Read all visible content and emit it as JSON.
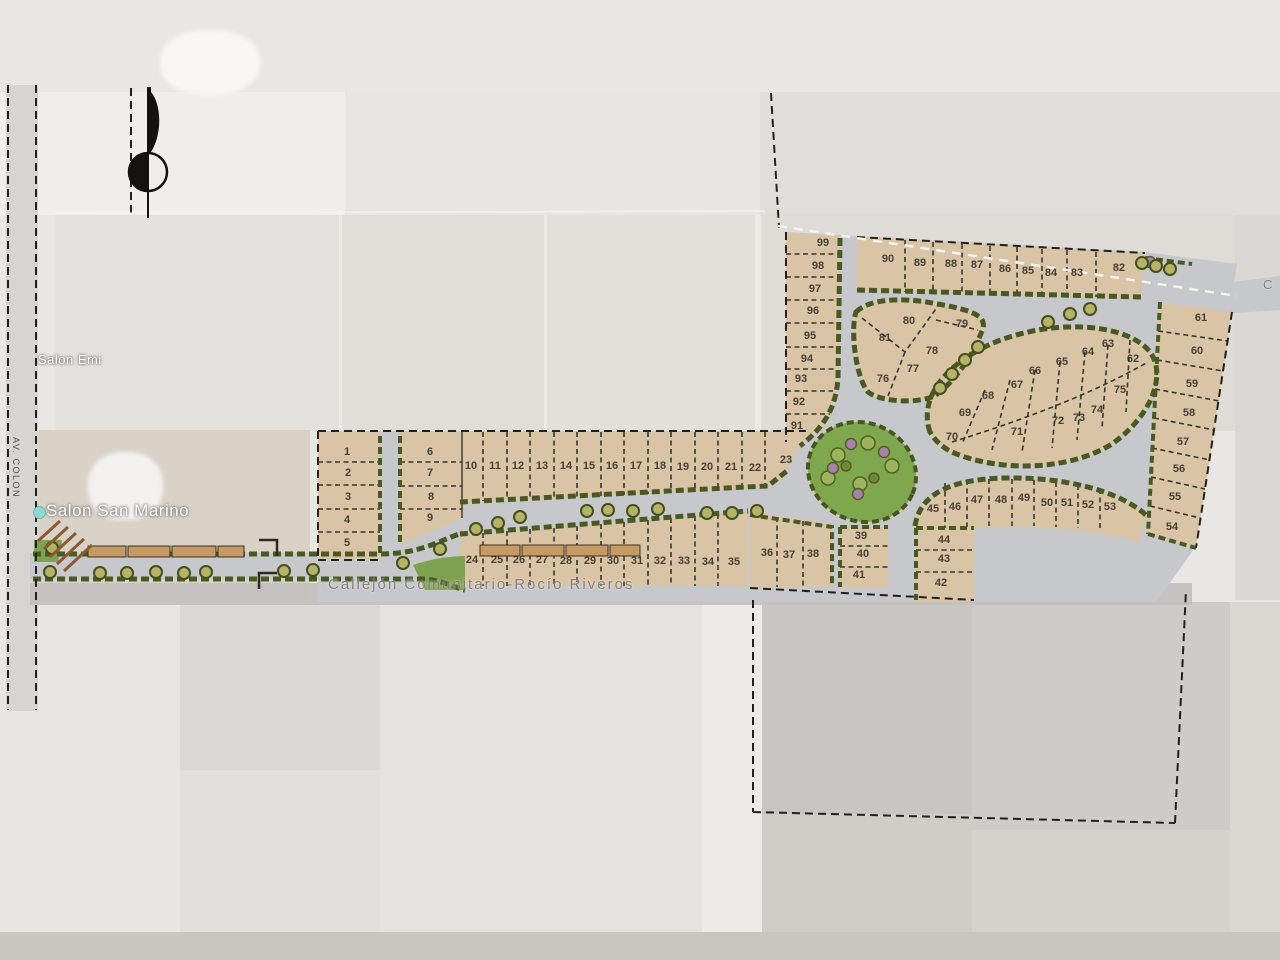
{
  "map": {
    "compass": {
      "icon": "north-arrow"
    },
    "labels": {
      "av_colon": "AV. COLON",
      "salon_emi": "Salon Emi",
      "salon_san_marino": "Salon San Marino",
      "callejon": "Callejón Comunitario-Rocío Riveros",
      "right_edge_street": "C"
    },
    "lots": [
      [
        "1",
        347,
        452
      ],
      [
        "2",
        348,
        473
      ],
      [
        "3",
        348,
        497
      ],
      [
        "4",
        347,
        520
      ],
      [
        "5",
        347,
        543
      ],
      [
        "6",
        430,
        452
      ],
      [
        "7",
        430,
        473
      ],
      [
        "8",
        431,
        497
      ],
      [
        "9",
        430,
        518
      ],
      [
        "10",
        471,
        466
      ],
      [
        "11",
        495,
        466
      ],
      [
        "12",
        518,
        466
      ],
      [
        "13",
        542,
        466
      ],
      [
        "14",
        566,
        466
      ],
      [
        "15",
        589,
        466
      ],
      [
        "16",
        612,
        466
      ],
      [
        "17",
        636,
        466
      ],
      [
        "18",
        660,
        466
      ],
      [
        "19",
        683,
        467
      ],
      [
        "20",
        707,
        467
      ],
      [
        "21",
        731,
        467
      ],
      [
        "22",
        755,
        468
      ],
      [
        "23",
        786,
        460
      ],
      [
        "24",
        472,
        560
      ],
      [
        "25",
        497,
        560
      ],
      [
        "26",
        519,
        560
      ],
      [
        "27",
        542,
        560
      ],
      [
        "28",
        566,
        561
      ],
      [
        "29",
        590,
        561
      ],
      [
        "30",
        613,
        561
      ],
      [
        "31",
        637,
        561
      ],
      [
        "32",
        660,
        561
      ],
      [
        "33",
        684,
        561
      ],
      [
        "34",
        708,
        562
      ],
      [
        "35",
        734,
        562
      ],
      [
        "36",
        767,
        553
      ],
      [
        "37",
        789,
        555
      ],
      [
        "38",
        813,
        554
      ],
      [
        "39",
        861,
        536
      ],
      [
        "40",
        863,
        554
      ],
      [
        "41",
        859,
        575
      ],
      [
        "42",
        941,
        583
      ],
      [
        "43",
        944,
        559
      ],
      [
        "44",
        944,
        540
      ],
      [
        "45",
        933,
        509
      ],
      [
        "46",
        955,
        507
      ],
      [
        "47",
        977,
        500
      ],
      [
        "48",
        1001,
        500
      ],
      [
        "49",
        1024,
        498
      ],
      [
        "50",
        1047,
        503
      ],
      [
        "51",
        1067,
        503
      ],
      [
        "52",
        1088,
        505
      ],
      [
        "53",
        1110,
        507
      ],
      [
        "54",
        1172,
        527
      ],
      [
        "55",
        1175,
        497
      ],
      [
        "56",
        1179,
        469
      ],
      [
        "57",
        1183,
        442
      ],
      [
        "58",
        1189,
        413
      ],
      [
        "59",
        1192,
        384
      ],
      [
        "60",
        1197,
        351
      ],
      [
        "61",
        1201,
        318
      ],
      [
        "62",
        1133,
        359
      ],
      [
        "63",
        1108,
        344
      ],
      [
        "64",
        1088,
        352
      ],
      [
        "65",
        1062,
        362
      ],
      [
        "66",
        1035,
        371
      ],
      [
        "67",
        1017,
        385
      ],
      [
        "68",
        988,
        396
      ],
      [
        "69",
        965,
        413
      ],
      [
        "70",
        952,
        437
      ],
      [
        "71",
        1017,
        432
      ],
      [
        "72",
        1058,
        421
      ],
      [
        "73",
        1079,
        418
      ],
      [
        "74",
        1097,
        410
      ],
      [
        "75",
        1120,
        390
      ],
      [
        "76",
        883,
        379
      ],
      [
        "77",
        913,
        369
      ],
      [
        "78",
        932,
        351
      ],
      [
        "79",
        962,
        324
      ],
      [
        "80",
        909,
        321
      ],
      [
        "81",
        885,
        338
      ],
      [
        "82",
        1119,
        268
      ],
      [
        "83",
        1077,
        273
      ],
      [
        "84",
        1051,
        273
      ],
      [
        "85",
        1028,
        271
      ],
      [
        "86",
        1005,
        269
      ],
      [
        "87",
        977,
        265
      ],
      [
        "88",
        951,
        264
      ],
      [
        "89",
        920,
        263
      ],
      [
        "90",
        888,
        259
      ],
      [
        "91",
        797,
        426
      ],
      [
        "92",
        799,
        402
      ],
      [
        "93",
        801,
        379
      ],
      [
        "94",
        807,
        359
      ],
      [
        "95",
        810,
        336
      ],
      [
        "96",
        813,
        311
      ],
      [
        "97",
        815,
        289
      ],
      [
        "98",
        818,
        266
      ],
      [
        "99",
        823,
        243
      ]
    ],
    "trees": [
      [
        50,
        572
      ],
      [
        100,
        573
      ],
      [
        127,
        573
      ],
      [
        156,
        572
      ],
      [
        184,
        573
      ],
      [
        206,
        572
      ],
      [
        284,
        571
      ],
      [
        313,
        570
      ],
      [
        403,
        563
      ],
      [
        440,
        549
      ],
      [
        476,
        529
      ],
      [
        498,
        523
      ],
      [
        520,
        517
      ],
      [
        587,
        511
      ],
      [
        608,
        510
      ],
      [
        633,
        511
      ],
      [
        658,
        509
      ],
      [
        707,
        513
      ],
      [
        732,
        513
      ],
      [
        757,
        511
      ],
      [
        940,
        388
      ],
      [
        952,
        374
      ],
      [
        965,
        360
      ],
      [
        978,
        347
      ],
      [
        1048,
        322
      ],
      [
        1070,
        314
      ],
      [
        1090,
        309
      ],
      [
        1142,
        263
      ],
      [
        1156,
        266
      ],
      [
        1170,
        269
      ],
      [
        52,
        548
      ]
    ],
    "park_bushes": {
      "green": [
        [
          838,
          455
        ],
        [
          868,
          443
        ],
        [
          892,
          466
        ],
        [
          860,
          484
        ],
        [
          828,
          478
        ]
      ],
      "purple": [
        [
          851,
          444
        ],
        [
          833,
          468
        ],
        [
          858,
          494
        ],
        [
          884,
          452
        ],
        [
          1150,
          262
        ]
      ],
      "dark": [
        [
          874,
          478
        ],
        [
          846,
          466
        ]
      ]
    }
  }
}
